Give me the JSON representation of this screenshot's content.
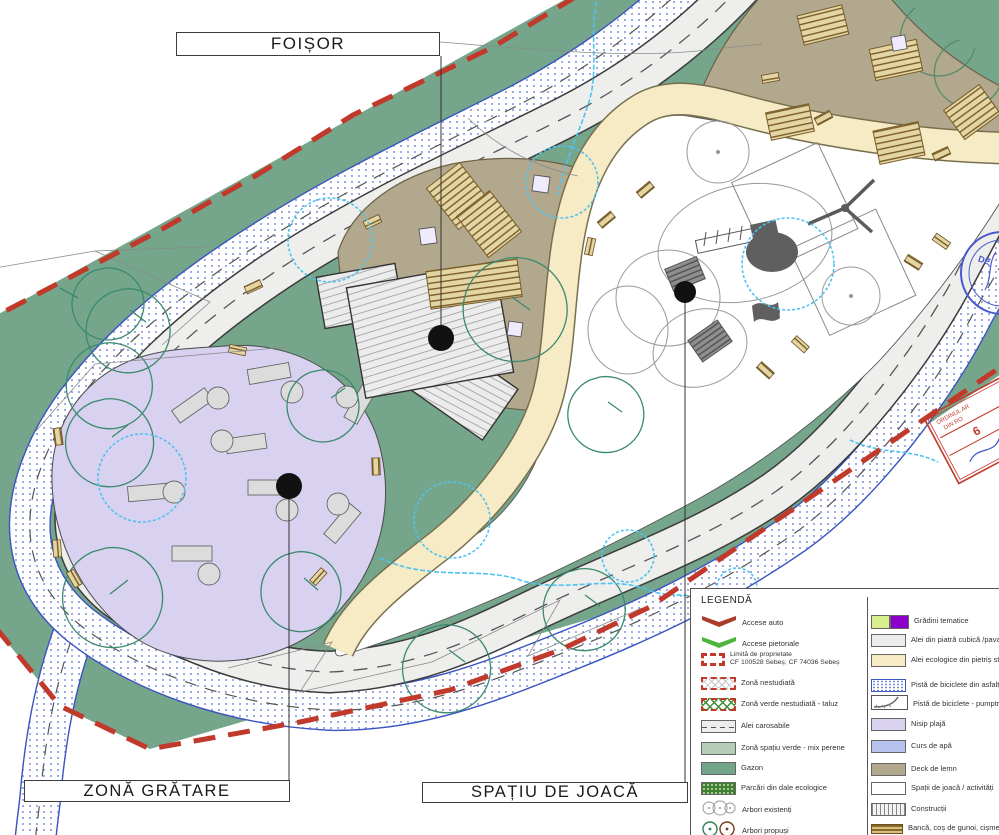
{
  "map_labels": {
    "foisor": "FOIȘOR",
    "zona_gratare": "ZONĂ GRĂTARE",
    "spatiu_de_joaca": "SPAȚIU DE JOACĂ"
  },
  "legend": {
    "title": "LEGENDĂ",
    "left": [
      {
        "label": "Accese auto"
      },
      {
        "label": "Accese pietonale"
      },
      {
        "label": "Limită de proprietate",
        "sublabel": "CF 100528 Sebeș; CF 74036 Sebeș"
      },
      {
        "label": "Zonă nestudiată"
      },
      {
        "label": "Zonă verde nestudiată - taluz"
      },
      {
        "label": "Alei carosabile"
      },
      {
        "label": "Zonă spațiu verde - mix perene"
      },
      {
        "label": "Gazon"
      },
      {
        "label": "Parcări din dale ecologice"
      },
      {
        "label": "Arbori existenți"
      },
      {
        "label": "Arbori propuși"
      }
    ],
    "right": [
      {
        "label": "Grădini tematice"
      },
      {
        "label": "Alei din piatră cubică /pavaj"
      },
      {
        "label": "Alei ecologice din pietriș stabilizat"
      },
      {
        "label": "Pistă de biciclete din asfalt"
      },
      {
        "label": "Pistă de biciclete - pumptruck"
      },
      {
        "label": "Nisip plajă"
      },
      {
        "label": "Curs de apă"
      },
      {
        "label": "Deck de lemn"
      },
      {
        "label": "Spații de joacă / activități"
      },
      {
        "label": "Construcții"
      },
      {
        "label": "Bancă, coș de gunoi, cișmea"
      }
    ]
  },
  "stamps": {
    "red_line1": "ORDINUL AR",
    "red_line2": "DIN RO",
    "red_number": "6",
    "blue_text": "DE"
  },
  "palette": {
    "gazon": "#75a68b",
    "mix_perene": "#b5cdb7",
    "nisip_plaja": "#d9d1f0",
    "alei_ecologice": "#f7ebc6",
    "alei_carosabile": "#eeeeec",
    "deck_lemn": "#b2a88d",
    "pista_biciclete": "#3b55c0",
    "curs_apa": "#4fc3f0",
    "limita_proprietate": "#c0392b",
    "parcari": "#3e8030",
    "gradini_galben": "#d9ef8d",
    "gradini_mov": "#8d00cc"
  }
}
